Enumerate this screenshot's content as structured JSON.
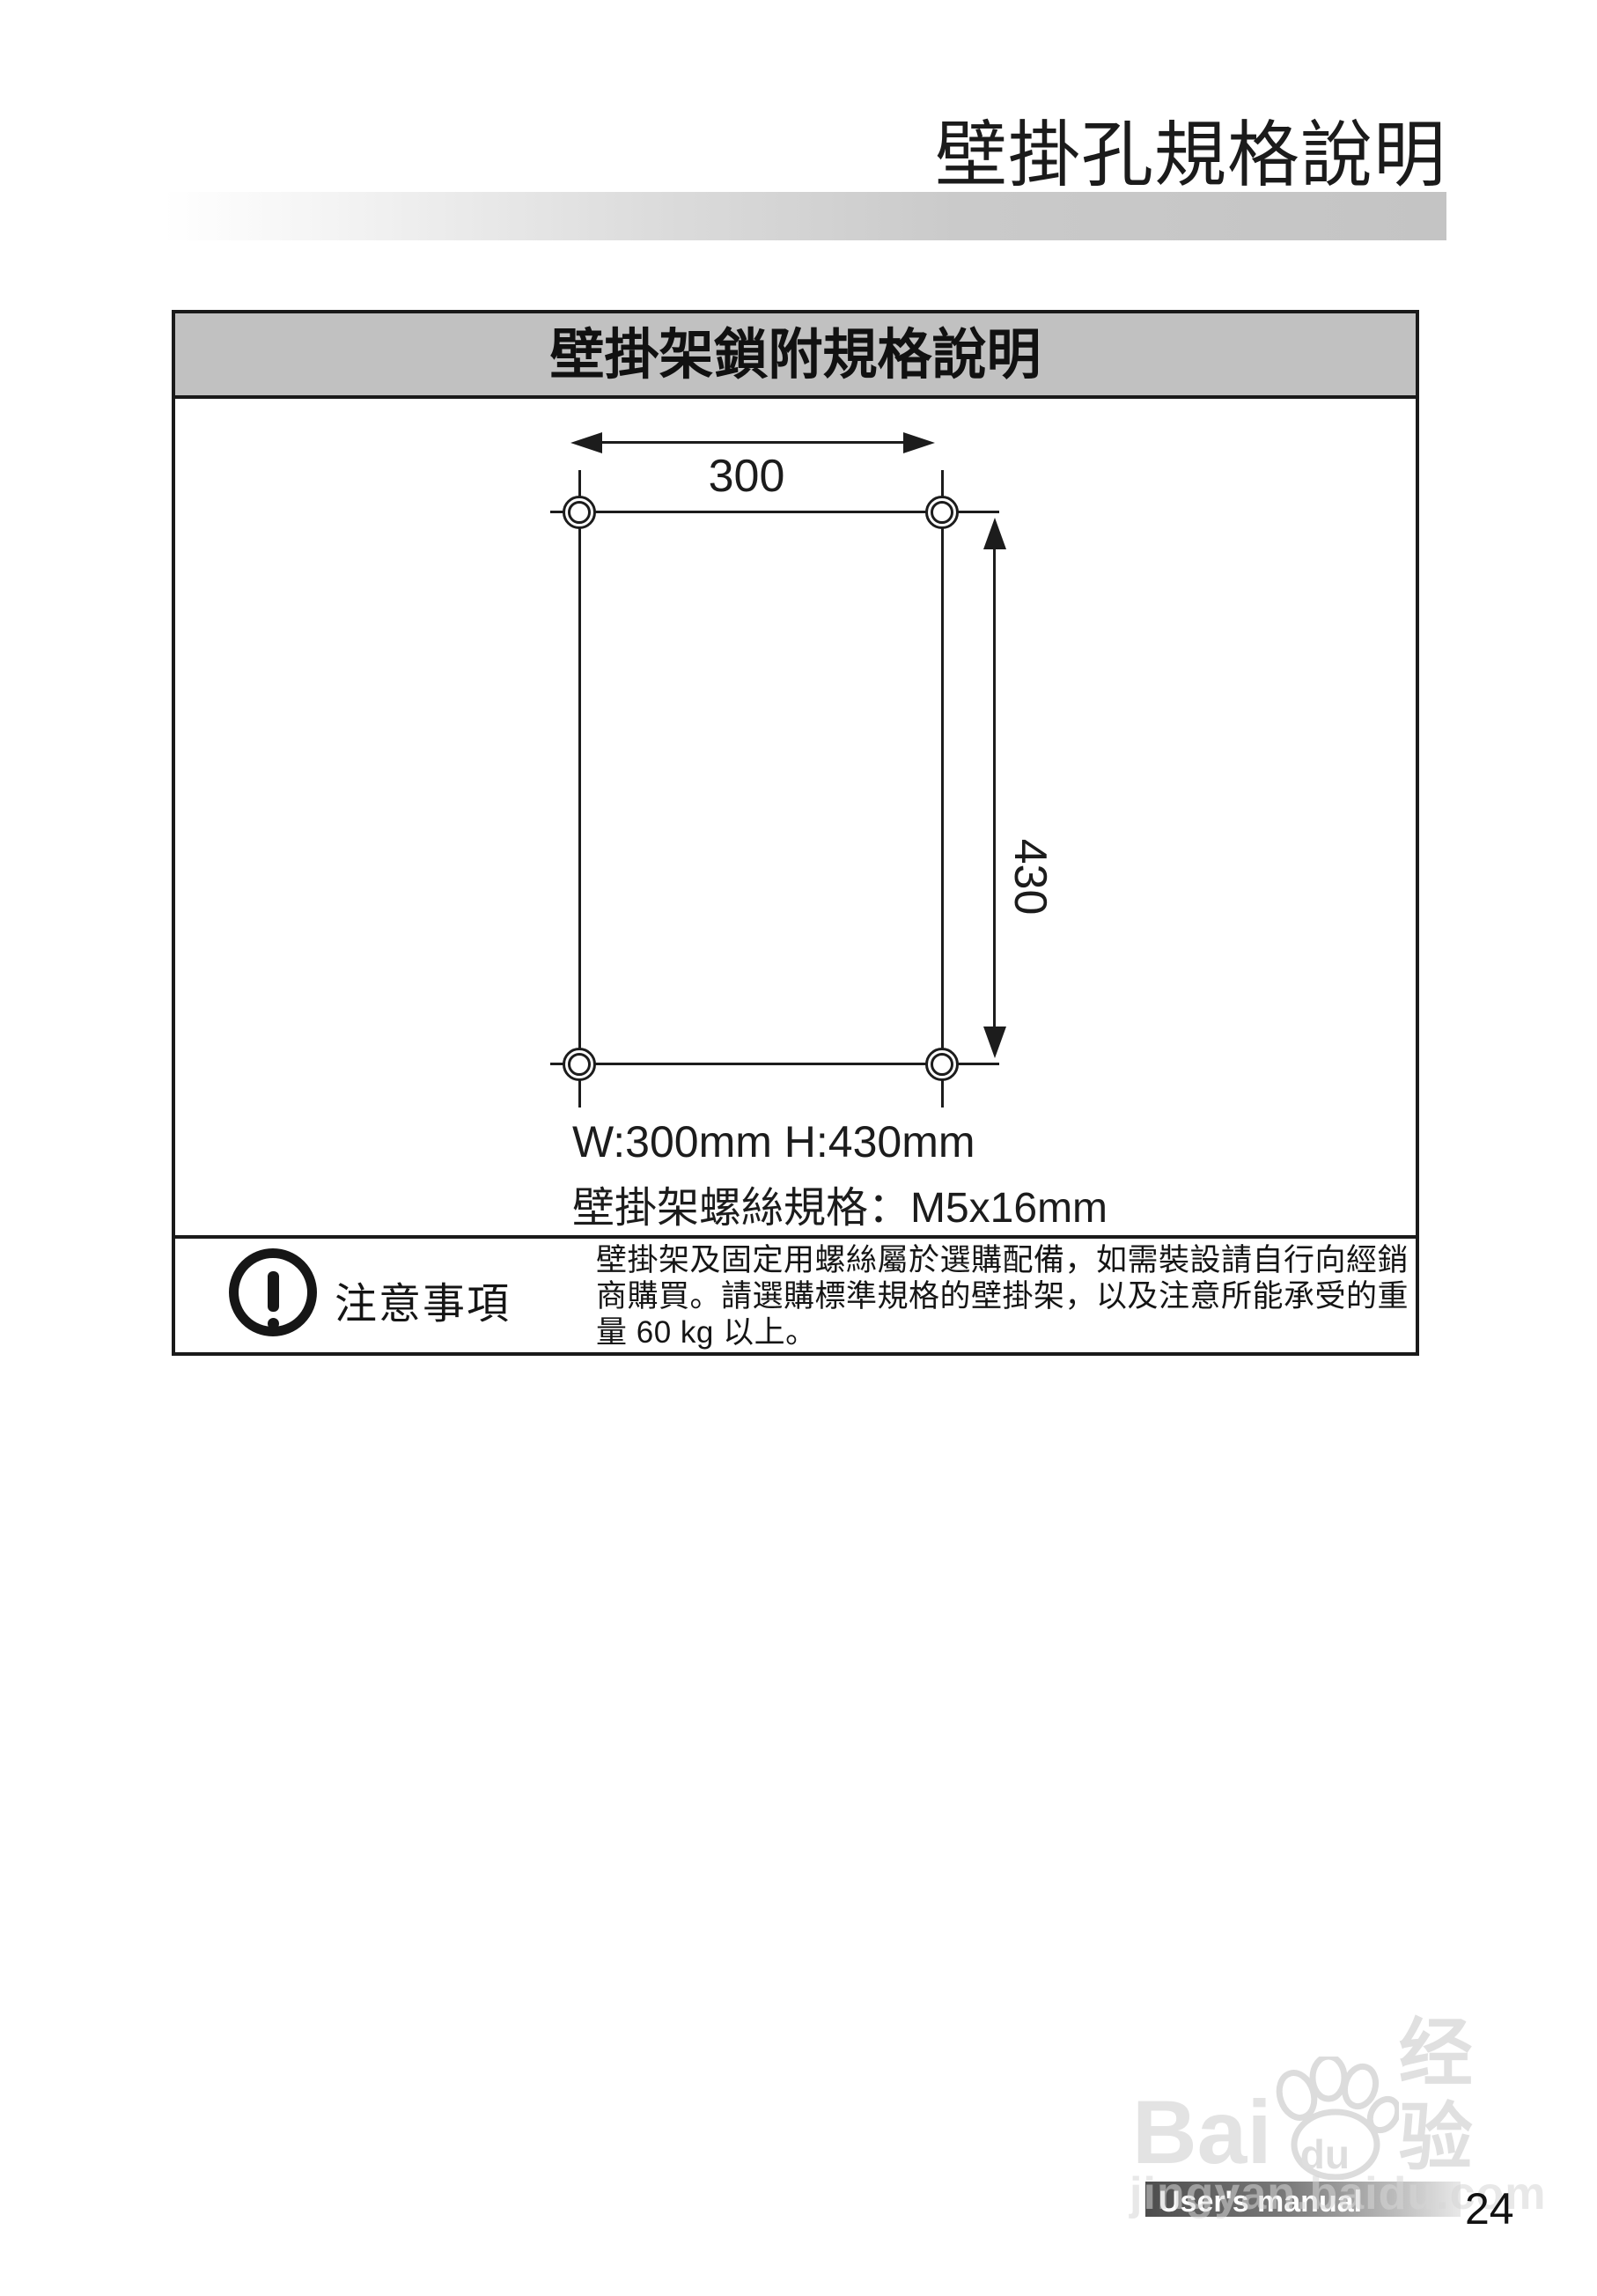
{
  "page": {
    "title": "壁掛孔規格說明",
    "page_number": "24"
  },
  "spec_box": {
    "header": "壁掛架鎖附規格說明",
    "diagram": {
      "width_dim": "300",
      "height_dim": "430",
      "size_label": "W:300mm H:430mm",
      "screw_spec": "壁掛架螺絲規格：M5x16mm"
    },
    "caution": {
      "label": "注意事項",
      "text": "壁掛架及固定用螺絲屬於選購配備，如需裝設請自行向經銷\n商購買。請選購標準規格的壁掛架，以及注意所能承受的重\n量 60 kg 以上。"
    }
  },
  "watermark": {
    "brand_prefix": "Bai",
    "brand_suffix": "du",
    "brand_cn": "经验",
    "url": "jingyan.baidu.com",
    "banner": "User's manual"
  },
  "colors": {
    "line": "#1c1c1c",
    "header_gray": "#c1c1c1",
    "bar_gradient_end": "#c4c4c4",
    "banner_dark": "#4d4d4d",
    "watermark_gray": "#e0e0e0"
  }
}
